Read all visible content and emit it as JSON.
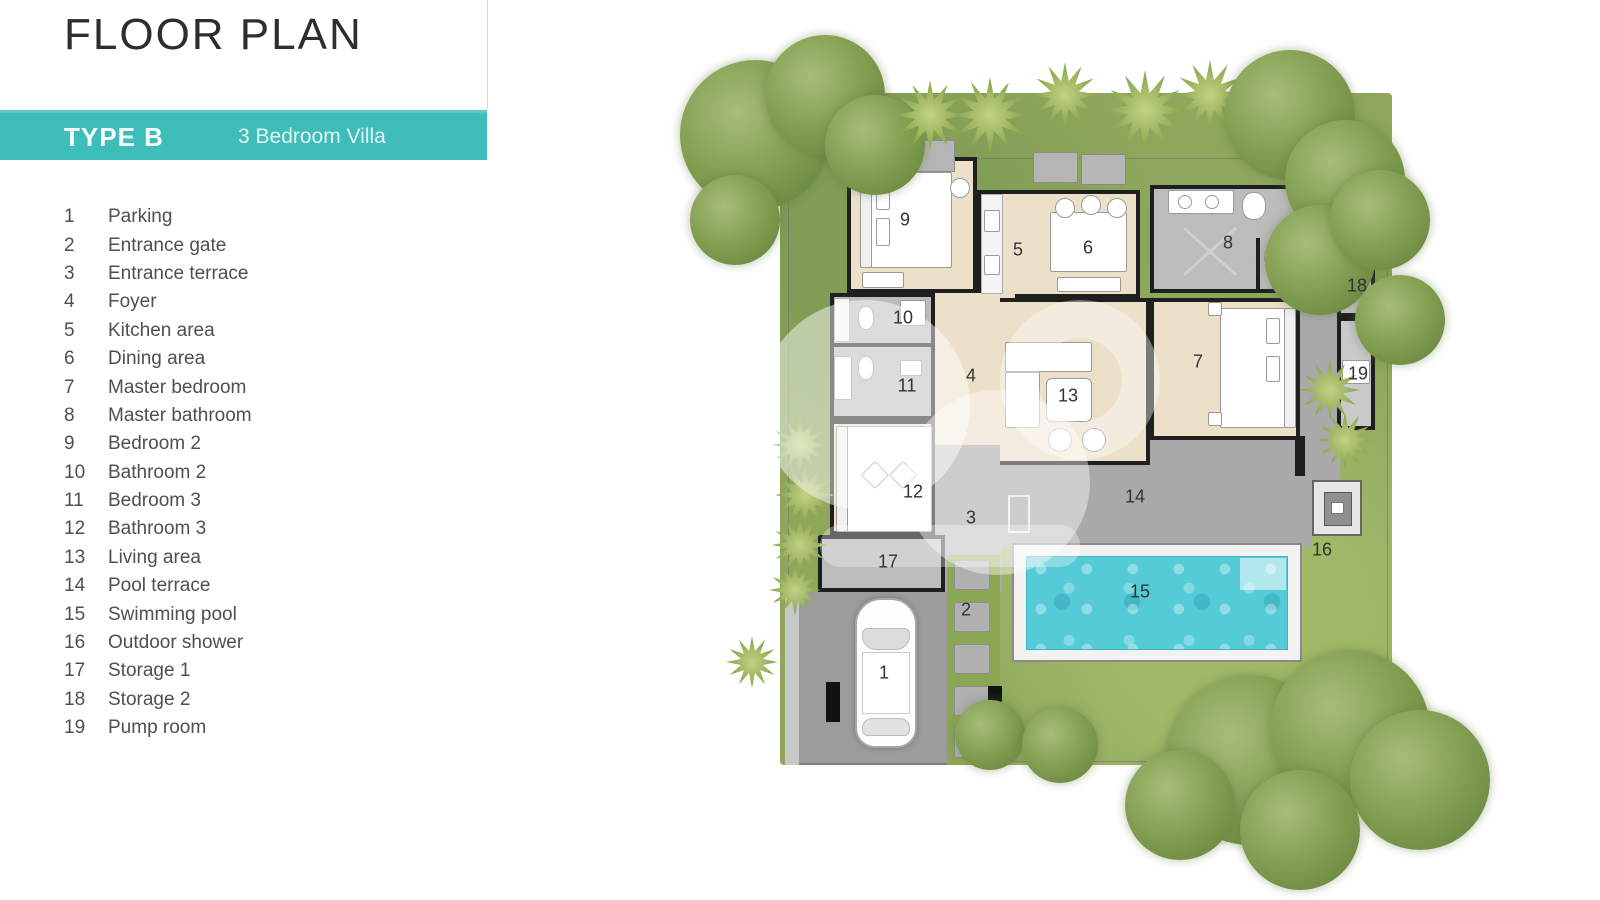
{
  "title": "FLOOR PLAN",
  "banner": {
    "type": "TYPE B",
    "subtitle": "3 Bedroom Villa"
  },
  "legend": {
    "items": [
      {
        "num": "1",
        "label": "Parking"
      },
      {
        "num": "2",
        "label": "Entrance gate"
      },
      {
        "num": "3",
        "label": "Entrance terrace"
      },
      {
        "num": "4",
        "label": "Foyer"
      },
      {
        "num": "5",
        "label": "Kitchen area"
      },
      {
        "num": "6",
        "label": "Dining area"
      },
      {
        "num": "7",
        "label": "Master bedroom"
      },
      {
        "num": "8",
        "label": "Master bathroom"
      },
      {
        "num": "9",
        "label": "Bedroom 2"
      },
      {
        "num": "10",
        "label": "Bathroom 2"
      },
      {
        "num": "11",
        "label": "Bedroom 3"
      },
      {
        "num": "12",
        "label": "Bathroom 3"
      },
      {
        "num": "13",
        "label": "Living area"
      },
      {
        "num": "14",
        "label": "Pool terrace"
      },
      {
        "num": "15",
        "label": "Swimming pool"
      },
      {
        "num": "16",
        "label": "Outdoor shower"
      },
      {
        "num": "17",
        "label": "Storage 1"
      },
      {
        "num": "18",
        "label": "Storage 2"
      },
      {
        "num": "19",
        "label": "Pump room"
      }
    ]
  },
  "colors": {
    "banner_teal": "#3fbdb9",
    "pool_water": "#56cbd8",
    "garden_green": "#8ea75c",
    "floor_beige": "#ece0c9",
    "wall_black": "#1f1f1f"
  }
}
